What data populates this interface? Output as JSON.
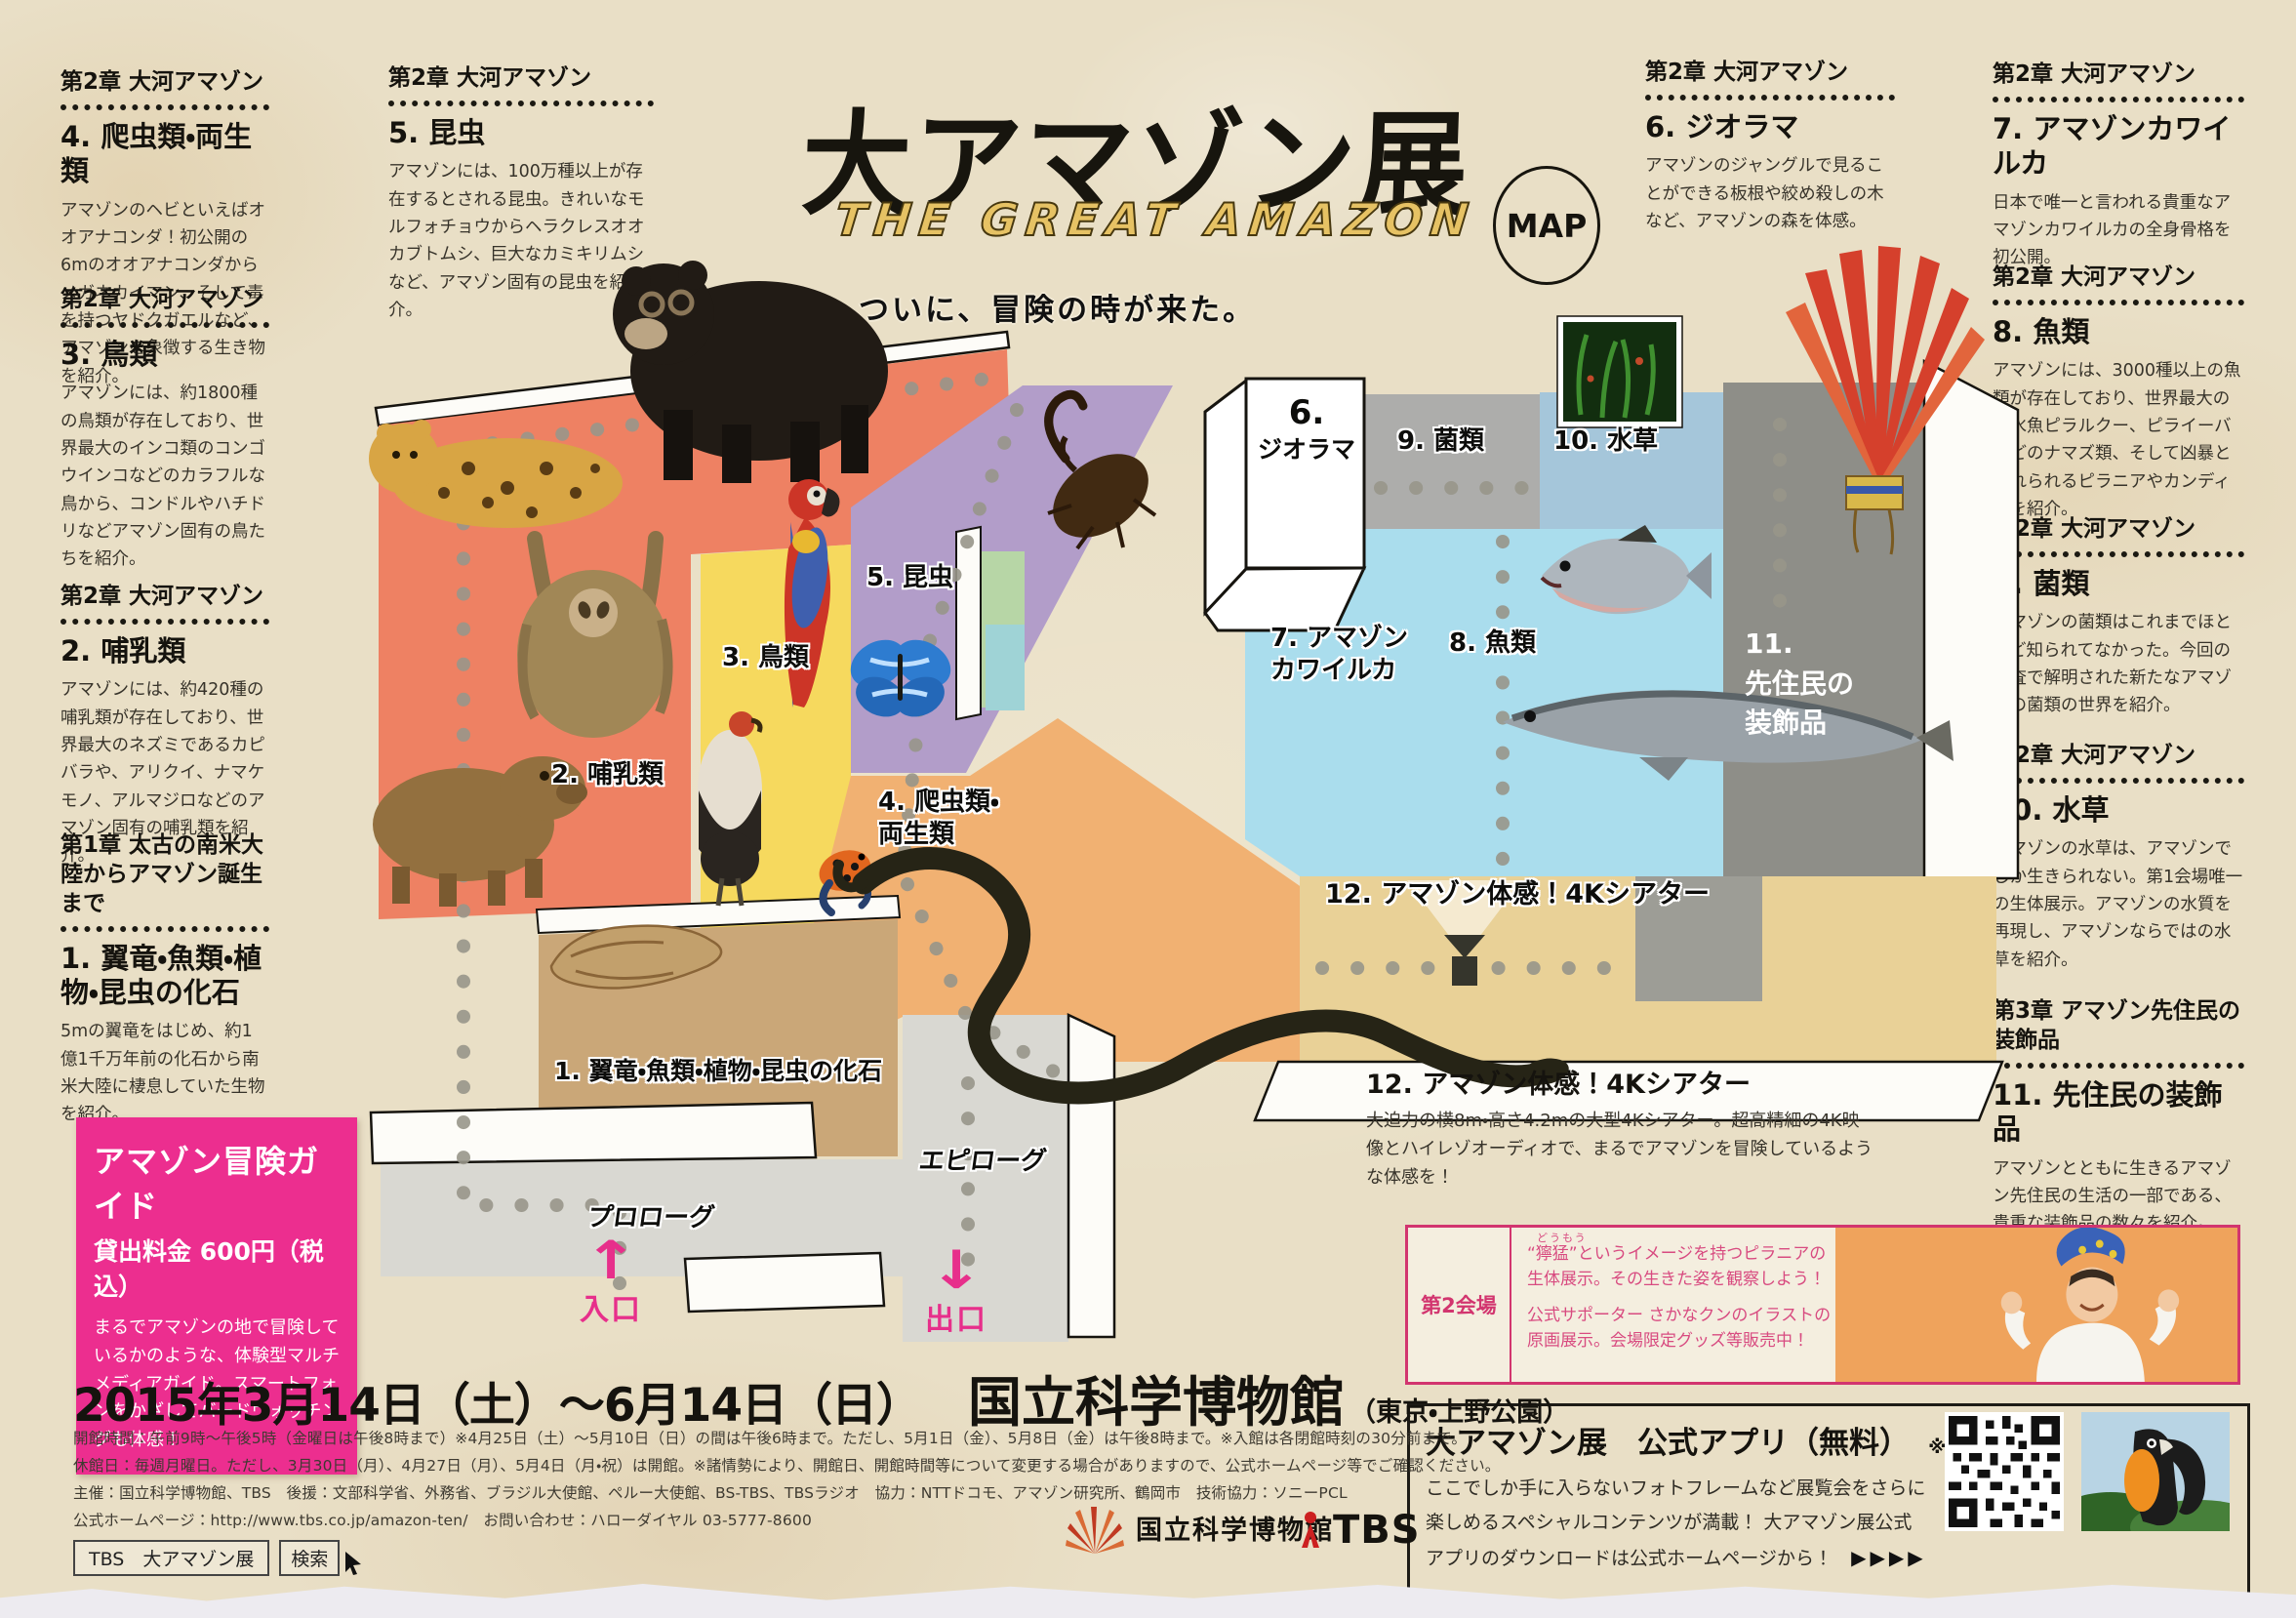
{
  "header": {
    "title": "大アマゾン展",
    "subtitle": "THE GREAT AMAZON",
    "map_badge": "MAP",
    "tagline": "ついに、冒険の時が来た。"
  },
  "sections": {
    "left": [
      {
        "chapter": "第2章 大河アマゾン",
        "number": "4.",
        "title": "爬虫類・両生類",
        "body": "アマゾンのヘビといえばオオアナコンダ！初公開の6mのオオアナコンダからメガネカイマン、そして毒を持つヤドクガエルなど、アマゾンを象徴する生き物を紹介。"
      },
      {
        "chapter": "第2章 大河アマゾン",
        "number": "3.",
        "title": "鳥類",
        "body": "アマゾンには、約1800種の鳥類が存在しており、世界最大のインコ類のコンゴウインコなどのカラフルな鳥から、コンドルやハチドリなどアマゾン固有の鳥たちを紹介。"
      },
      {
        "chapter": "第2章 大河アマゾン",
        "number": "2.",
        "title": "哺乳類",
        "body": "アマゾンには、約420種の哺乳類が存在しており、世界最大のネズミであるカピバラや、アリクイ、ナマケモノ、アルマジロなどのアマゾン固有の哺乳類を紹介。"
      },
      {
        "chapter": "第1章 太古の南米大陸からアマゾン誕生まで",
        "number": "1.",
        "title": "翼竜・魚類・植物・昆虫の化石",
        "body": "5mの翼竜をはじめ、約1億1千万年前の化石から南米大陸に棲息していた生物を紹介。"
      }
    ],
    "insects": {
      "chapter": "第2章 大河アマゾン",
      "number": "5.",
      "title": "昆虫",
      "body": "アマゾンには、100万種以上が存在するとされる昆虫。きれいなモルフォチョウからヘラクレスオオカブトムシ、巨大なカミキリムシなど、アマゾン固有の昆虫を紹介。"
    },
    "diorama": {
      "chapter": "第2章 大河アマゾン",
      "number": "6.",
      "title": "ジオラマ",
      "body": "アマゾンのジャングルで見ることができる板根や絞め殺しの木など、アマゾンの森を体感。"
    },
    "right": [
      {
        "chapter": "第2章 大河アマゾン",
        "number": "7.",
        "title": "アマゾンカワイルカ",
        "body": "日本で唯一と言われる貴重なアマゾンカワイルカの全身骨格を初公開。"
      },
      {
        "chapter": "第2章 大河アマゾン",
        "number": "8.",
        "title": "魚類",
        "body": "アマゾンには、3000種以上の魚類が存在しており、世界最大の淡水魚ピラルクー、ピライーバなどのナマズ類、そして凶暴と恐れられるピラニアやカンディルを紹介。"
      },
      {
        "chapter": "第2章 大河アマゾン",
        "number": "9.",
        "title": "菌類",
        "body": "アマゾンの菌類はこれまでほとんど知られてなかった。今回の調査で解明された新たなアマゾンの菌類の世界を紹介。"
      },
      {
        "chapter": "第2章 大河アマゾン",
        "number": "10.",
        "title": "水草",
        "body": "アマゾンの水草は、アマゾンでしか生きられない。第1会場唯一の生体展示。アマゾンの水質を再現し、アマゾンならではの水草を紹介。"
      },
      {
        "chapter": "第3章 アマゾン先住民の装飾品",
        "number": "11.",
        "title": "先住民の装飾品",
        "body": "アマゾンとともに生きるアマゾン先住民の生活の一部である、貴重な装飾品の数々を紹介。"
      }
    ],
    "theater": {
      "heading": "12. アマゾン体感！4Kシアター",
      "body": "大迫力の横8m・高さ4.2mの大型4Kシアター。超高精細の4K映像とハイレゾオーディオで、まるでアマゾンを冒険しているような体感を！"
    }
  },
  "guide": {
    "title": "アマゾン冒険ガイド",
    "price": "貸出料金 600円（税込）",
    "body": "まるでアマゾンの地で冒険しているかのような、体験型マルチメディアガイド。スマートフォンをかざしてバードウォッチングも体感！"
  },
  "map": {
    "zones": {
      "z1": "1. 翼竜・魚類・植物・昆虫の化石",
      "z2": "2. 哺乳類",
      "z3": "3. 鳥類",
      "z4a": "4. 爬虫類・",
      "z4b": "両生類",
      "z5": "5. 昆虫",
      "z6n": "6.",
      "z6t": "ジオラマ",
      "z7a": "7. アマゾン",
      "z7b": "カワイルカ",
      "z8": "8. 魚類",
      "z9": "9. 菌類",
      "z10": "10. 水草",
      "z11a": "11.",
      "z11b": "先住民の",
      "z11c": "装飾品",
      "z12": "12. アマゾン体感！4Kシアター"
    },
    "prologue": "プロローグ",
    "epilogue": "エピローグ",
    "entrance": "入口",
    "exit": "出口",
    "animals": [
      "jaguar",
      "spectacled-bear",
      "sloth",
      "capybara",
      "macaw",
      "king-vulture",
      "hercules-beetle",
      "morpho-butterfly",
      "poison-dart-frog",
      "anaconda",
      "piranha",
      "arowana",
      "fossil",
      "water-plants",
      "feather-headdress",
      "projector"
    ],
    "colors": {
      "mammal": "#ee8163",
      "birds": "#f6d95e",
      "insects": "#b29dc9",
      "reptiles": "#f1b172",
      "fossil": "#caa778",
      "theater": "#e9d197",
      "water": "#aadded",
      "fungi": "#adadab",
      "plants": "#a5c6da",
      "ornament": "#8e8e88",
      "corridor": "#d9d8d2",
      "accent_pink": "#e72f8b"
    }
  },
  "venue2": {
    "label": "第2会場",
    "furigana": "どうもう",
    "line1": "“獰猛”というイメージを持つピラニアの",
    "line2": "生体展示。その生きた姿を観察しよう！",
    "line3": "公式サポーター さかなクンのイラストの",
    "line4": "原画展示。会場限定グッズ等販売中！"
  },
  "app": {
    "title": "大アマゾン展　公式アプリ（無料）",
    "note": "※会期中のみ",
    "line1": "ここでしか手に入らないフォトフレームなど展覧会をさらに",
    "line2": "楽しめるスペシャルコンテンツが満載！ 大アマゾン展公式",
    "line3": "アプリのダウンロードは公式ホームページから！",
    "arrows": "▶▶▶▶"
  },
  "footer": {
    "date": "2015年3月14日（土）〜6月14日（日）",
    "venue": "国立科学博物館",
    "venue_note": "（東京・上野公園）",
    "hours": "開館時間：午前9時〜午後5時（金曜日は午後8時まで）※4月25日（土）〜5月10日（日）の間は午後6時まで。ただし、5月1日（金）、5月8日（金）は午後8時まで。※入館は各閉館時刻の30分前まで。",
    "closed": "休館日：毎週月曜日。ただし、3月30日（月）、4月27日（月）、5月4日（月・祝）は開館。※諸情勢により、開館日、開館時間等について変更する場合がありますので、公式ホームページ等でご確認ください。",
    "credits": "主催：国立科学博物館、TBS　後援：文部科学省、外務省、ブラジル大使館、ペルー大使館、BS-TBS、TBSラジオ　協力：NTTドコモ、アマゾン研究所、鶴岡市　技術協力：ソニーPCL",
    "website": "公式ホームページ：http://www.tbs.co.jp/amazon-ten/　お問い合わせ：ハローダイヤル 03-5777-8600",
    "search_terms": "TBS　大アマゾン展",
    "search_button": "検索",
    "kahaku_logo": "国立科学博物館",
    "tbs_logo": "TBS"
  }
}
